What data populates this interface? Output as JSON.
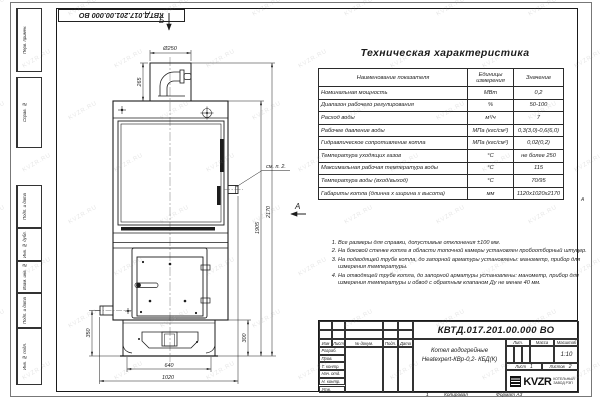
{
  "sheet": {
    "doc_number_top": "КВТД.017.201.00.000 ВО",
    "copied_label": "Копировал",
    "format_label": "Формат А3",
    "zone_number": "1",
    "zone_letter": "А",
    "watermark": "KVZR.RU",
    "line_color": "#1c1c1c",
    "paper_color": "#ffffff"
  },
  "side_strip": [
    "Перв. примен.",
    "Справ. №",
    "Подп. и дата",
    "Инв. № дубл.",
    "Взам. инв. №",
    "Подп. и дата",
    "Инв. № подл."
  ],
  "view_labels": {
    "top_arrow": "Б",
    "side_arrow": "А",
    "callout_note2": "см. п. 2."
  },
  "dimensions": {
    "chimney_diameter": "Ø250",
    "chimney_height": "265",
    "total_height": "2170",
    "body_height": "1905",
    "base_height": "300",
    "stub_height": "350",
    "base_width": "640",
    "overall_width": "1020"
  },
  "table": {
    "title": "Техническая характеристика",
    "headers": [
      "Наименование показателя",
      "Единицы измерения",
      "Значение"
    ],
    "rows": [
      [
        "Номинальная мощность",
        "МВт",
        "0,2"
      ],
      [
        "Диапазон рабочего регулирования",
        "%",
        "50-100"
      ],
      [
        "Расход воды",
        "м³/ч",
        "7"
      ],
      [
        "Рабочее давление воды",
        "МПа (кгс/см²)",
        "0,3(3,0)-0,6(6,0)"
      ],
      [
        "Гидравлическое сопротивление котла",
        "МПа (кгс/см²)",
        "0,02(0,2)"
      ],
      [
        "Температура уходящих газов",
        "°С",
        "не более 250"
      ],
      [
        "Максимальная рабочая температура воды",
        "°С",
        "115"
      ],
      [
        "Температура воды (вход/выход)",
        "°С",
        "70/95"
      ],
      [
        "Габариты котла (длинна х ширина х высота)",
        "мм",
        "1120х1020х2170"
      ]
    ]
  },
  "notes": [
    "Все размеры для справки, допустимые отклонения ±100 мм.",
    "На боковой стенке котла в области топочной камеры установлен пробоотборный штуцер.",
    "На подводящей трубе котла, до запорной арматуры установлены: манометр, прибор для измерения температуры.",
    "На отводящей трубе котла, до запорной арматуры установлены: манометр, прибор для измерения температуры и обвод с обратным клапаном Ду не менее 40 мм."
  ],
  "title_block": {
    "doc_number": "КВТД.017.201.00.000 ВО",
    "product_name_1": "Котел водогрейные",
    "product_name_2": "Heatexpert-КВр-0,2- КБД(К)",
    "rev_headers": [
      "Изм",
      "Лист",
      "№ докум.",
      "Подп.",
      "Дата"
    ],
    "sig_rows": [
      "Разраб.",
      "Пров.",
      "Т. контр.",
      "Нач. отд.",
      "Н. контр.",
      "Утв."
    ],
    "lit_label": "Лит.",
    "mass_label": "Масса",
    "scale_label": "Масштаб",
    "scale_value": "1:10",
    "sheet_label": "Лист",
    "sheet_value": "1",
    "sheets_label": "Листов",
    "sheets_value": "2",
    "logo_text": "KVZR",
    "logo_caption_1": "КОТЕЛЬНЫЙ",
    "logo_caption_2": "ЗАВОД РЭП"
  }
}
